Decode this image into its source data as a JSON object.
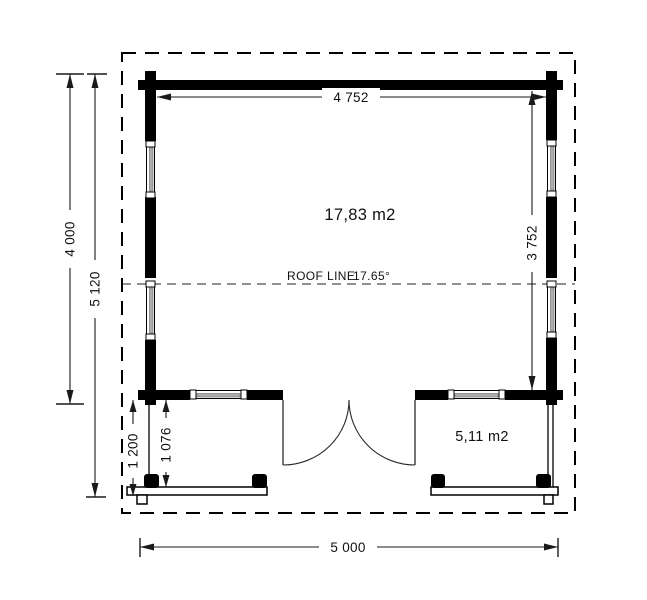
{
  "plan": {
    "main_room": {
      "area_label": "17,83 m2"
    },
    "porch": {
      "area_label": "5,11 m2"
    },
    "roof": {
      "label": "ROOF LINE",
      "angle_label": "17.65°"
    },
    "dimensions": {
      "interior_width": "4 752",
      "interior_depth": "3 752",
      "building_depth": "4 000",
      "overall_depth": "5 120",
      "porch_depth_outer": "1 200",
      "porch_depth_inner": "1 076",
      "overall_width": "5 000"
    },
    "colors": {
      "line": "#000000",
      "window_glass": "#adadad",
      "background": "#ffffff"
    }
  }
}
